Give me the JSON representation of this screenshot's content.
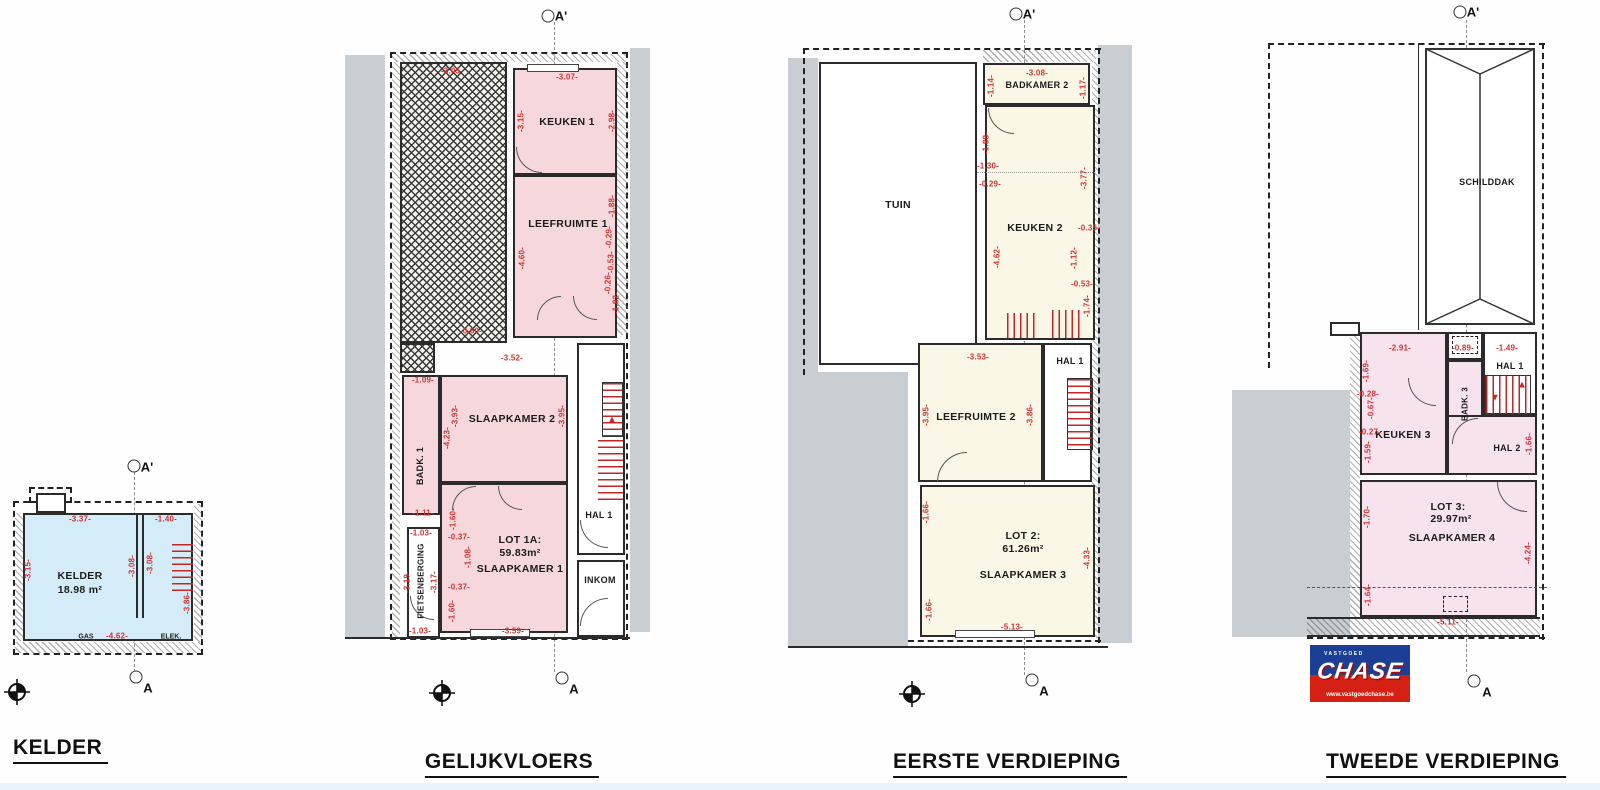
{
  "markers": {
    "a_top": "A'",
    "a_bottom": "A"
  },
  "colors": {
    "dimension_red": "#cf3434",
    "wall": "#2b2b2b",
    "neighbour_gray": "#c9ced3",
    "kelder_fill": "#d3ecf7",
    "gelijkvloers_fill": "#f6d8dc",
    "eerste_fill": "#faf7e6",
    "tweede_fill": "#f7e3ee",
    "logo_blue": "#1b3f94",
    "logo_red": "#d42114"
  },
  "floors": {
    "kelder": {
      "title": "KELDER",
      "room": "KELDER",
      "area": "18.98 m²",
      "gas": "GAS",
      "elek": "ELEK.",
      "dims": [
        "-3.37-",
        "-1.40-",
        "-3.15-",
        "-3.08-",
        "-3.08-",
        "-3.86-",
        "-4.62-"
      ]
    },
    "gelijkvloers": {
      "title": "GELIJKVLOERS",
      "rooms": {
        "keuken1": "KEUKEN 1",
        "leefruimte1": "LEEFRUIMTE 1",
        "slaapkamer2": "SLAAPKAMER 2",
        "badk1": "BADK. 1",
        "lot": "LOT 1A:",
        "lot_area": "59.83m²",
        "slaapkamer1": "SLAAPKAMER 1",
        "fietsenberging": "FIETSENBERGING",
        "hal1": "HAL 1",
        "inkom": "INKOM"
      },
      "dims": [
        "-3.05-",
        "-3.07-",
        "-3.15-",
        "-2.98-",
        "-1.88-",
        "-0.29-",
        "-0.53-",
        "-0.26-",
        "-1.82-",
        "-4.60-",
        "-0.60-",
        "-1.09-",
        "-3.52-",
        "-3.93-",
        "-3.95-",
        "-4.23-",
        "-1.11-",
        "-1.03-",
        "-3.19-",
        "-3.17-",
        "-1.03-",
        "-1.60-",
        "-0.37-",
        "-1.08-",
        "-0.37-",
        "-1.60-",
        "-3.59-"
      ]
    },
    "eerste": {
      "title": "EERSTE VERDIEPING",
      "rooms": {
        "tuin": "TUIN",
        "badkamer2": "BADKAMER 2",
        "keuken2": "KEUKEN 2",
        "leefruimte2": "LEEFRUIMTE 2",
        "hal1": "HAL 1",
        "lot": "LOT 2:",
        "lot_area": "61.26m²",
        "slaapkamer3": "SLAAPKAMER 3"
      },
      "dims": [
        "-3.08-",
        "-1.14-",
        "-1.17-",
        "-1.88-",
        "-1.30-",
        "-0.29-",
        "-3.77-",
        "-0.35-",
        "-4.62-",
        "-1.12-",
        "-0.53-",
        "-1.74-",
        "-3.53-",
        "-3.95-",
        "-3.86-",
        "-1.66-",
        "-1.66-",
        "-4.33-",
        "-5.13-"
      ]
    },
    "tweede": {
      "title": "TWEEDE VERDIEPING",
      "rooms": {
        "schilddak": "SCHILDDAK",
        "hal1": "HAL 1",
        "badk3": "BADK. 3",
        "keuken3": "KEUKEN 3",
        "hal2": "HAL 2",
        "lot": "LOT 3:",
        "lot_area": "29.97m²",
        "slaapkamer4": "SLAAPKAMER 4"
      },
      "dims": [
        "-2.91-",
        "-0.89-",
        "-1.49-",
        "-1.69-",
        "-0.28-",
        "-0.67-",
        "-0.27-",
        "-1.59-",
        "-1.66-",
        "-1.70-",
        "-4.24-",
        "-1.64-",
        "-5.11-"
      ]
    }
  },
  "logo": {
    "brand": "CHASE",
    "tagline": "VASTGOED",
    "url": "www.vastgoedchase.be"
  }
}
